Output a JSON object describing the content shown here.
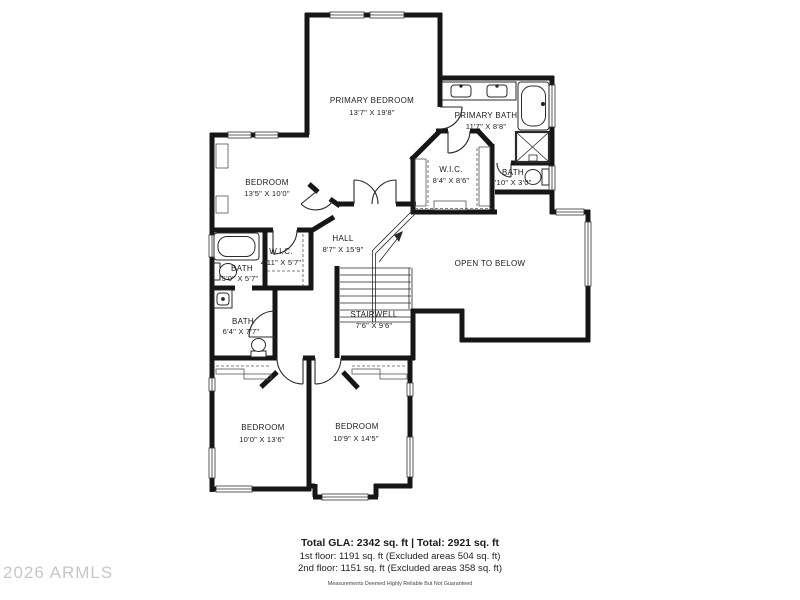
{
  "watermark": "2026 ARMLS",
  "rooms": {
    "primary_bedroom": {
      "name": "PRIMARY BEDROOM",
      "dims": "13'7\" X 19'8\""
    },
    "primary_bath": {
      "name": "PRIMARY BATH",
      "dims": "11'7\" X 8'8\""
    },
    "wic_primary": {
      "name": "W.I.C.",
      "dims": "8'4\" X 8'6\""
    },
    "bath_small": {
      "name": "BATH",
      "dims": "5'10\" X 3'0\""
    },
    "bedroom_left": {
      "name": "BEDROOM",
      "dims": "13'5\" X 10'0\""
    },
    "hall": {
      "name": "HALL",
      "dims": "8'7\" X 15'9\""
    },
    "wic_small": {
      "name": "W.I.C.",
      "dims": "4'11\" X 5'7\""
    },
    "bath_tub": {
      "name": "BATH",
      "dims": "5'0\" X 5'7\""
    },
    "bath_vanity": {
      "name": "BATH",
      "dims": "6'4\" X 7'7\""
    },
    "stairwell": {
      "name": "STAIRWELL",
      "dims": "7'6\" X 9'6\""
    },
    "open_to_below": {
      "name": "OPEN TO BELOW"
    },
    "bedroom_bottom_left": {
      "name": "BEDROOM",
      "dims": "10'0\" X 13'6\""
    },
    "bedroom_bottom_right": {
      "name": "BEDROOM",
      "dims": "10'9\" X 14'5\""
    }
  },
  "footer": {
    "total_line": "Total GLA: 2342 sq. ft | Total: 2921 sq. ft",
    "first_floor_line": "1st floor: 1191 sq. ft (Excluded areas 504 sq. ft)",
    "second_floor_line": "2nd floor: 1151 sq. ft (Excluded areas 358 sq. ft)",
    "disclaimer": "Measurements Deemed Highly Reliable But Not Guaranteed"
  },
  "colors": {
    "wall": "#161616",
    "thin_line": "#2a2a2a",
    "watermark": "#c7c7c7"
  }
}
